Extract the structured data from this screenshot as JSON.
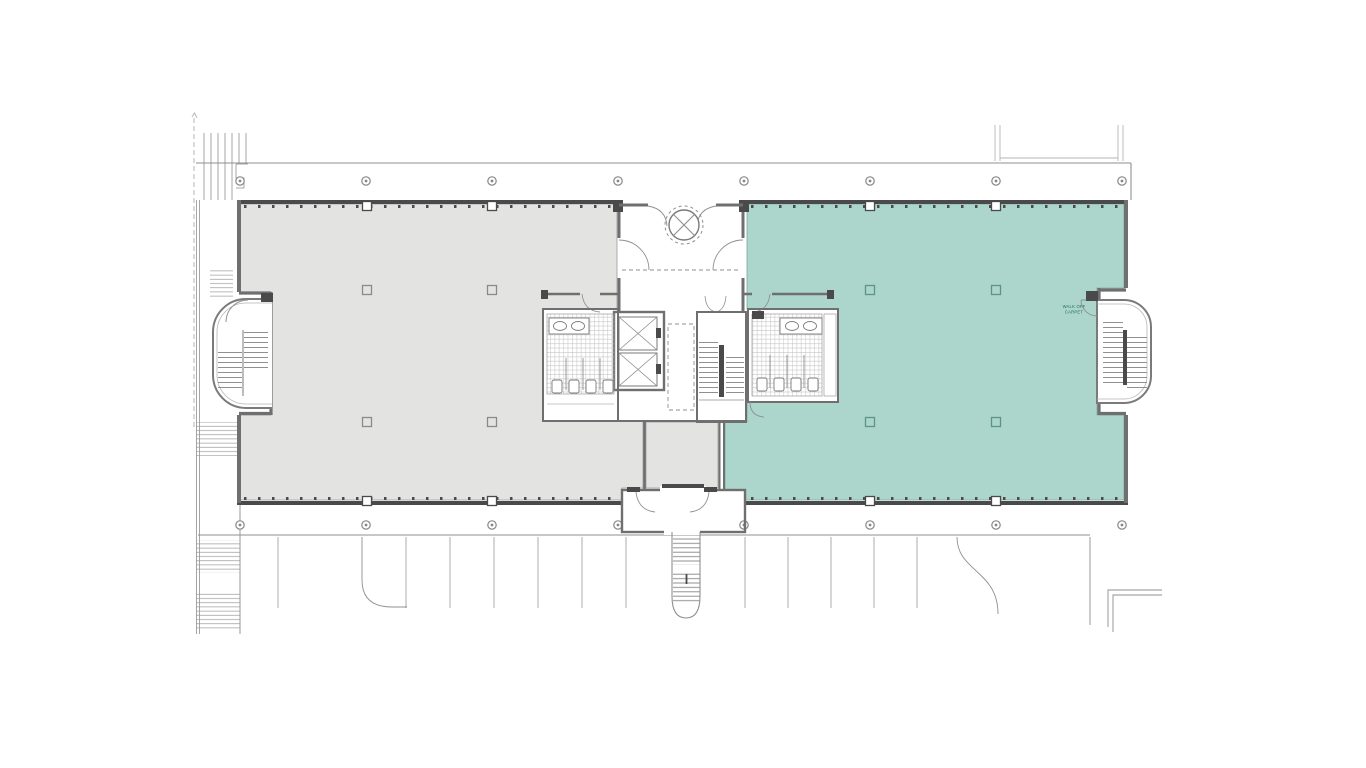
{
  "title": "office-building-floor-plan",
  "colors": {
    "background": "#ffffff",
    "suite_left": "#e3e4e2",
    "suite_right": "#acd6cb",
    "wall_dark": "#4a4a4a",
    "wall_mid": "#6f6f6f",
    "line_med": "#8f8f8f",
    "line_light": "#b5b5b5",
    "fixture": "#7a7a7a",
    "note": "#23695d",
    "column_teal_stroke": "#5d9488",
    "column_gray_stroke": "#8a8a8a"
  },
  "annotations": {
    "stair_note_line1": "WALK OFF",
    "stair_note_line2": "CARPET"
  },
  "repeats": {
    "bollards": {
      "xs": [
        240,
        366,
        492,
        618,
        744,
        870,
        996,
        1122
      ],
      "y_top": 181,
      "y_bottom": 525,
      "r": 4.2
    },
    "columns": {
      "size": 9,
      "in_wall": [
        [
          367,
          206
        ],
        [
          492,
          206
        ],
        [
          870,
          206
        ],
        [
          996,
          206
        ],
        [
          367,
          501
        ],
        [
          492,
          501
        ],
        [
          870,
          501
        ],
        [
          996,
          501
        ]
      ],
      "on_gray": [
        [
          367,
          290
        ],
        [
          492,
          290
        ],
        [
          367,
          422
        ],
        [
          492,
          422
        ]
      ],
      "on_teal": [
        [
          870,
          290
        ],
        [
          996,
          290
        ],
        [
          870,
          422
        ],
        [
          996,
          422
        ]
      ]
    },
    "parking_stalls": {
      "left_xs": [
        278,
        406,
        450,
        494,
        538,
        582,
        626
      ],
      "right_xs": [
        745,
        788,
        831,
        874,
        917
      ],
      "y1": 537,
      "y2": 608
    }
  }
}
